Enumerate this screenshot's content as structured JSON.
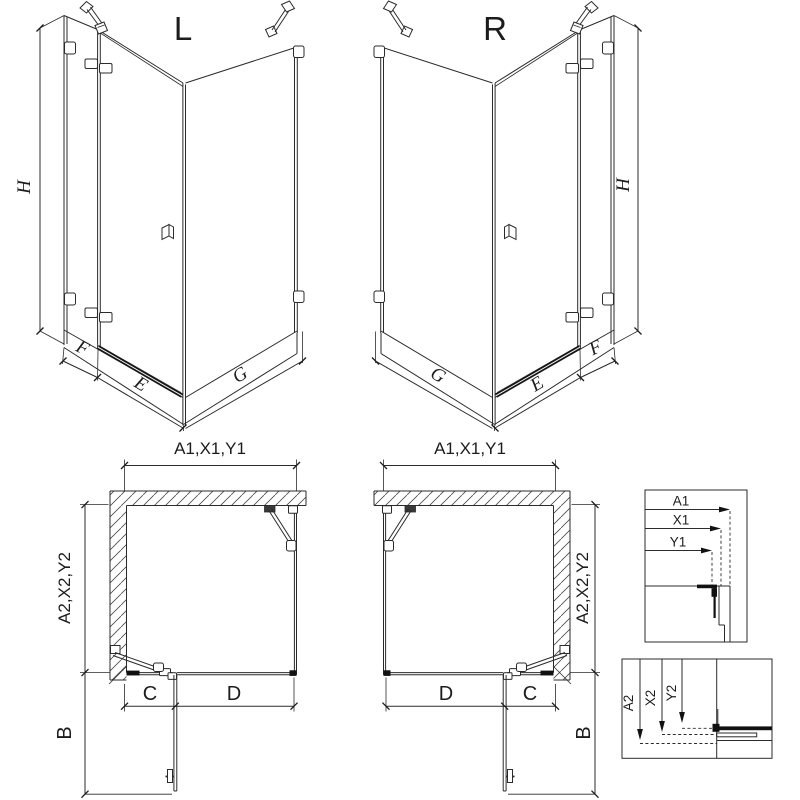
{
  "page": {
    "type": "shower-enclosure-technical-diagram",
    "background_color": "#ffffff",
    "line_color": "#2b2b2b",
    "accent_dark_color": "#111111"
  },
  "variants": {
    "left": {
      "label": "L"
    },
    "right": {
      "label": "R"
    }
  },
  "perspective_dimensions": {
    "height": "H",
    "fixed_strip_width": "F",
    "door_width": "E",
    "side_panel_width": "G"
  },
  "plan_dimensions": {
    "overall_width": "A1,X1,Y1",
    "overall_depth": "A2,X2,Y2",
    "strip_width": "C",
    "door_panel_width": "D",
    "door_swing_depth": "B"
  },
  "detail_boxes": {
    "width_adjustment": {
      "labels": [
        "A1",
        "X1",
        "Y1"
      ]
    },
    "depth_adjustment": {
      "labels": [
        "A2",
        "X2",
        "Y2"
      ]
    }
  }
}
